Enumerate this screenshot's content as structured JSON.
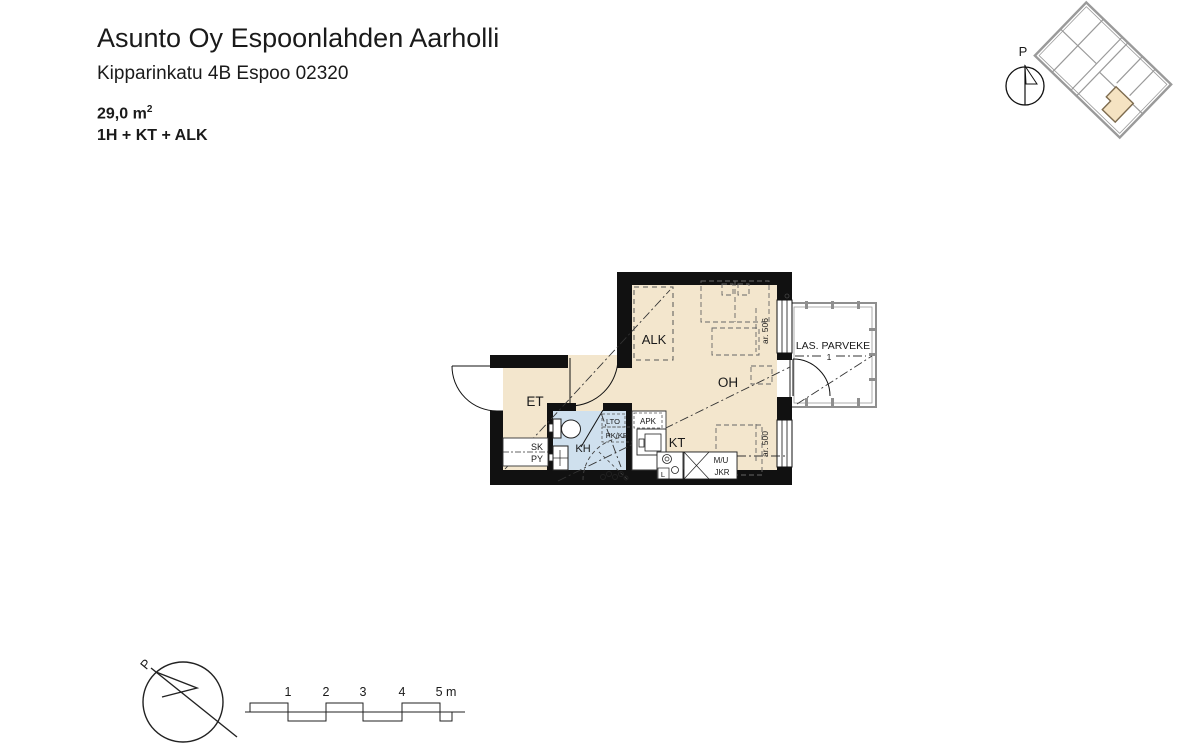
{
  "header": {
    "project": "Asunto Oy Espoonlahden Aarholli",
    "address": "Kipparinkatu 4B Espoo 02320",
    "area_value": "29,0 m",
    "area_sup": "2",
    "layout_code": "1H + KT + ALK"
  },
  "location_diagram": {
    "caption": "Sijaintikaavio",
    "north_label": "P"
  },
  "floor_plan": {
    "rooms": {
      "alk": "ALK",
      "oh": "OH",
      "et": "ET",
      "kt": "KT",
      "kh": "KH",
      "balcony": "LAS. PARVEKE"
    },
    "fixtures": {
      "sk": "SK",
      "py": "PY",
      "lto": "LTO",
      "pk_kr": "PK/KR",
      "apk": "APK",
      "stove": "L",
      "mu": "M/U",
      "jkr": "JKR"
    },
    "annotations": {
      "ar_upper": "ar. 506",
      "ar_lower": "ar. 500",
      "balcony_mark": "1"
    }
  },
  "scale_bar": {
    "north_label": "P",
    "labels": [
      "1",
      "2",
      "3",
      "4",
      "5 m"
    ]
  }
}
